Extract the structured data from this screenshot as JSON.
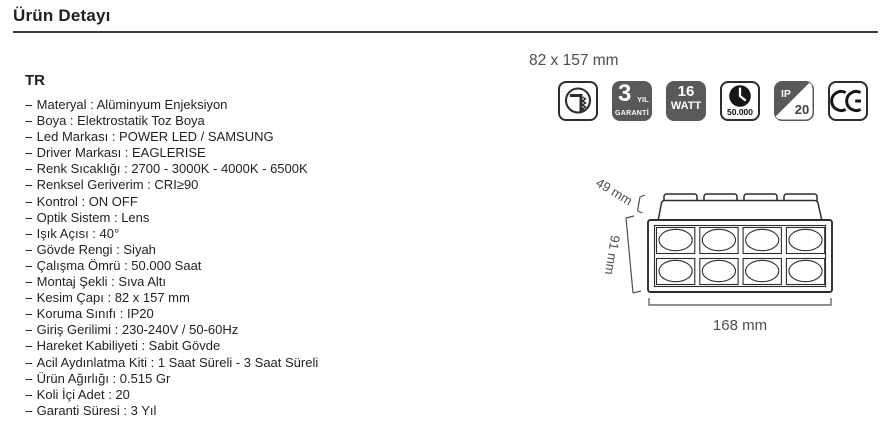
{
  "header": {
    "title": "Ürün Detayı"
  },
  "section": {
    "language": "TR"
  },
  "specs": {
    "bullet": "--",
    "separator": " : ",
    "items": [
      {
        "label": "Materyal",
        "value": "Alüminyum Enjeksiyon"
      },
      {
        "label": "Boya",
        "value": "Elektrostatik Toz Boya"
      },
      {
        "label": "Led Markası",
        "value": "POWER LED / SAMSUNG"
      },
      {
        "label": "Driver Markası",
        "value": "EAGLERISE"
      },
      {
        "label": "Renk Sıcaklığı",
        "value": "2700 - 3000K - 4000K - 6500K"
      },
      {
        "label": "Renksel Geriverim",
        "value": "CRI≥90"
      },
      {
        "label": "Kontrol",
        "value": "ON OFF"
      },
      {
        "label": "Optik Sistem",
        "value": "Lens"
      },
      {
        "label": "Işık Açısı",
        "value": "40°"
      },
      {
        "label": "Gövde Rengi",
        "value": "Siyah"
      },
      {
        "label": "Çalışma Ömrü",
        "value": "50.000 Saat"
      },
      {
        "label": "Montaj Şekli",
        "value": "Sıva Altı"
      },
      {
        "label": "Kesim Çapı",
        "value": "82 x 157 mm"
      },
      {
        "label": "Koruma Sınıfı",
        "value": "IP20"
      },
      {
        "label": "Giriş Gerilimi",
        "value": "230-240V / 50-60Hz"
      },
      {
        "label": "Hareket Kabiliyeti",
        "value": "Sabit Gövde"
      },
      {
        "label": "Acil Aydınlatma Kiti",
        "value": "1 Saat Süreli - 3 Saat Süreli"
      },
      {
        "label": "Ürün Ağırlığı",
        "value": "0.515 Gr"
      },
      {
        "label": "Koli İçi Adet",
        "value": "20"
      },
      {
        "label": "Garanti Süresi",
        "value": "3 Yıl"
      }
    ]
  },
  "badges": {
    "cutout_dimension": "82 x 157 mm",
    "warranty": {
      "number": "3",
      "unit": "YIL",
      "word": "GARANTİ"
    },
    "power": {
      "value": "16",
      "unit": "WATT"
    },
    "lifetime": {
      "hours": "50.000"
    },
    "ip": {
      "prefix": "IP",
      "rating": "20"
    },
    "ce_label": "CE"
  },
  "drawing": {
    "depth_label": "49 mm",
    "height_label": "91 mm",
    "width_label": "168 mm"
  },
  "colors": {
    "badge_gray": "#58595b",
    "line_dark": "#2d2d2f",
    "text_dark": "#231f20",
    "dim_gray": "#4d4d4f"
  }
}
